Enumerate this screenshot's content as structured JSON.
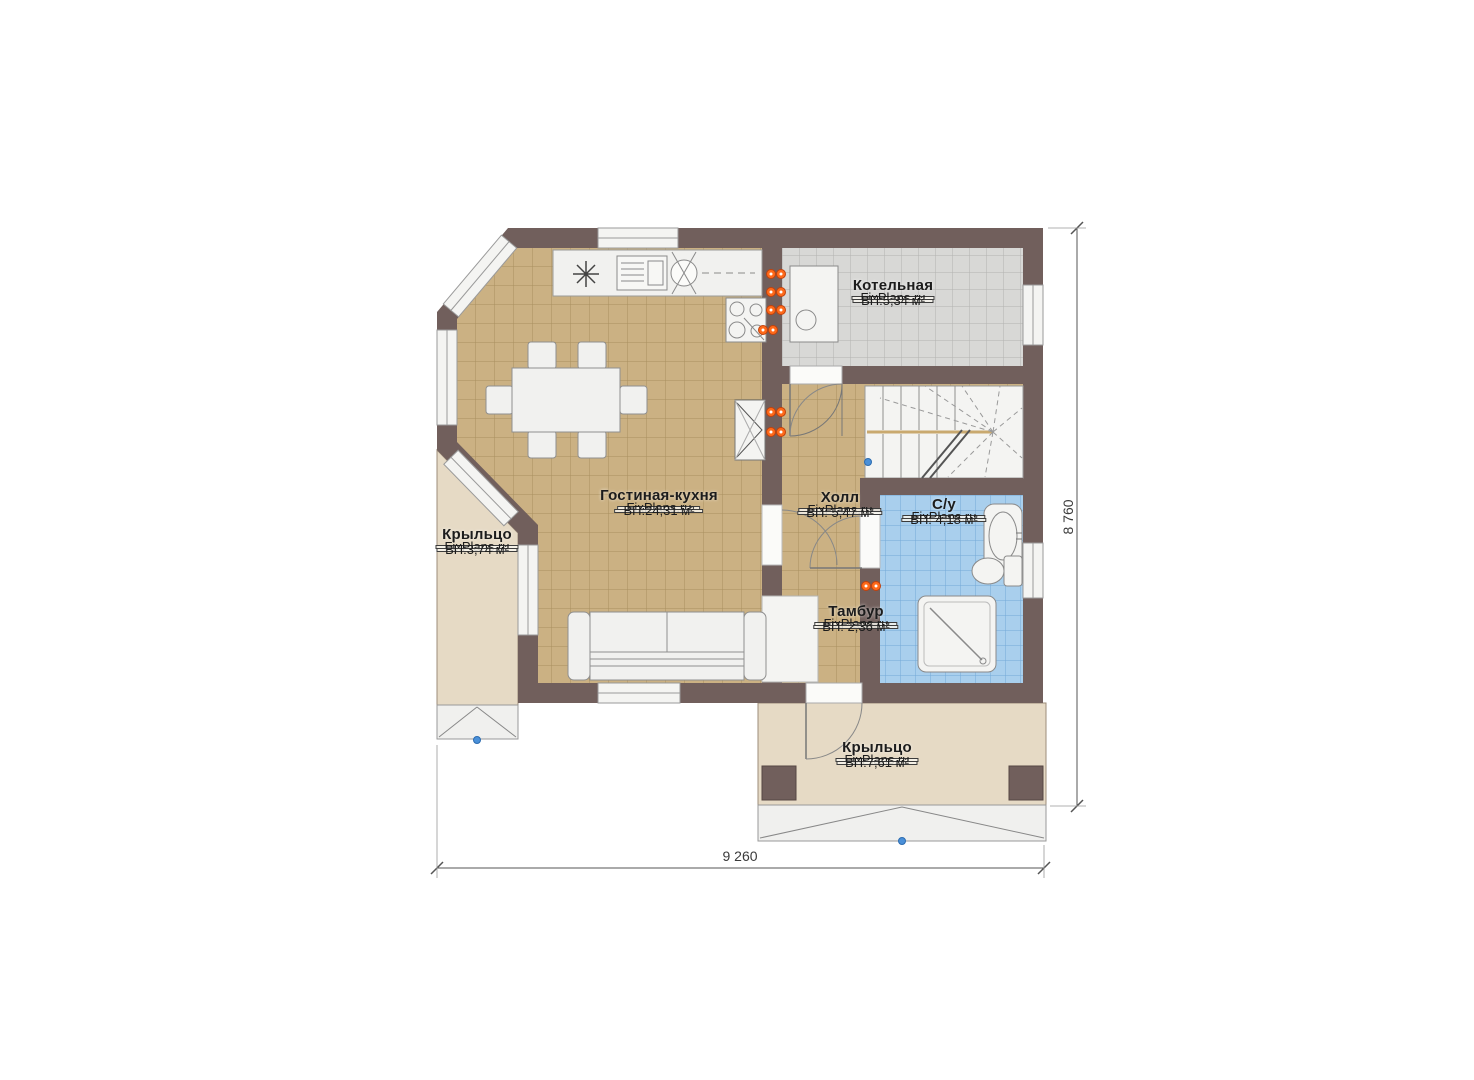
{
  "plan": {
    "type": "floor-plan",
    "dimensions": {
      "width_label": "9 260",
      "height_label": "8 760"
    }
  },
  "rooms": [
    {
      "id": "kotelnaya",
      "name": "Котельная",
      "brand": "FixPlans.ru",
      "area": "ВП:5,34 м²"
    },
    {
      "id": "gostinaya",
      "name": "Гостиная-кухня",
      "brand": "FixPlans.ru",
      "area": "ВП:24,31 м²"
    },
    {
      "id": "holl",
      "name": "Холл",
      "brand": "FixPlans.ru",
      "area": "ВП: 5,47 м²"
    },
    {
      "id": "su",
      "name": "С/у",
      "brand": "FixPlans.ru",
      "area": "ВП: 4,18 м²"
    },
    {
      "id": "tambur",
      "name": "Тамбур",
      "brand": "FixPlans.ru",
      "area": "ВП: 2,36 м²"
    },
    {
      "id": "kryltso-left",
      "name": "Крыльцо",
      "brand": "FixPlans.ru",
      "area": "ВП:3,74 м²"
    },
    {
      "id": "kryltso-bottom",
      "name": "Крыльцо",
      "brand": "FixPlans.ru",
      "area": "ВП:7,61 м²"
    }
  ],
  "colors": {
    "wall": "#715f5c",
    "floor_tan": "#cbb183",
    "floor_gray": "#d8d8d6",
    "floor_blue": "#a9cfed",
    "porch": "#e6dac5",
    "fixture": "#f4f4f2",
    "outlet_orange": "#ff6a1a",
    "marker_blue": "#4a90d9"
  }
}
